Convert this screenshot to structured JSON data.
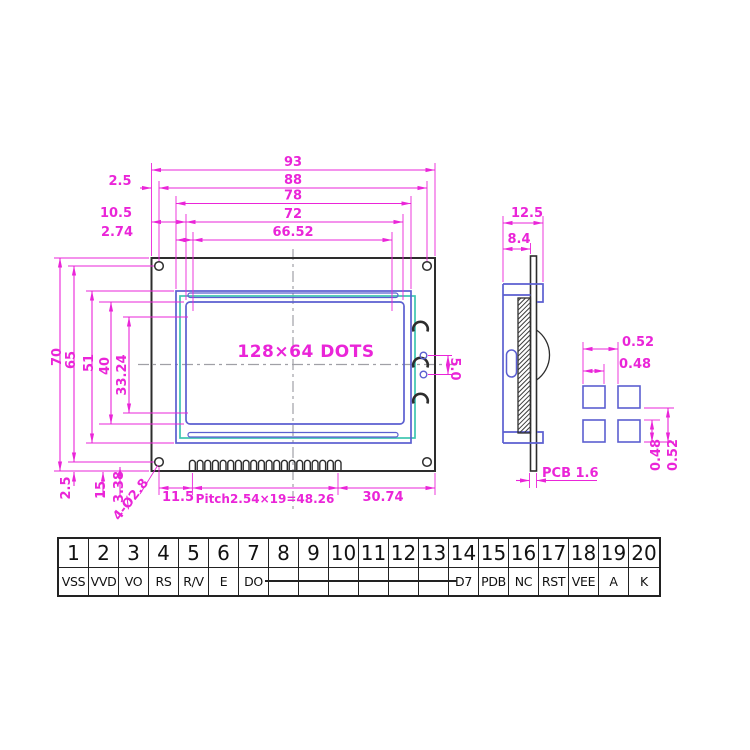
{
  "front_view": {
    "display_label": "128×64 DOTS",
    "dim_93": "93",
    "dim_88": "88",
    "dim_78": "78",
    "dim_72": "72",
    "dim_6652": "66.52",
    "dim_25_top": "2.5",
    "dim_105": "10.5",
    "dim_274": "2.74",
    "dim_70": "70",
    "dim_65": "65",
    "dim_51": "51",
    "dim_40": "40",
    "dim_3324": "33.24",
    "dim_25_bottom": "2.5",
    "dim_15": "15",
    "dim_338": "3.38",
    "hole_callout": "4-Ø2.8",
    "dim_115": "11.5",
    "dim_pitch": "Pitch2.54×19=48.26",
    "dim_3074": "30.74",
    "dim_50": "5.0"
  },
  "side_view": {
    "dim_125": "12.5",
    "dim_84": "8.4",
    "pcb_label": "PCB 1.6"
  },
  "pad_detail": {
    "dim_052_top": "0.52",
    "dim_048_top": "0.48",
    "dim_048_right": "0.48",
    "dim_052_right": "0.52"
  },
  "pin_table": {
    "numbers": [
      "1",
      "2",
      "3",
      "4",
      "5",
      "6",
      "7",
      "8",
      "9",
      "10",
      "11",
      "12",
      "13",
      "14",
      "15",
      "16",
      "17",
      "18",
      "19",
      "20"
    ],
    "labels": [
      "VSS",
      "VVD",
      "VO",
      "RS",
      "R/V",
      "E",
      "DO",
      "",
      "",
      "",
      "",
      "",
      "",
      "D7",
      "PDB",
      "NC",
      "RST",
      "VEE",
      "A",
      "K"
    ]
  },
  "colors": {
    "dimension_magenta": "#ea25d8",
    "bezel_blue": "#5b5fd0",
    "frame_teal": "#3ec6b0",
    "drawing_black": "#2d2d2d",
    "centerline_gray": "#a0a0a6",
    "table_black": "#222222"
  }
}
